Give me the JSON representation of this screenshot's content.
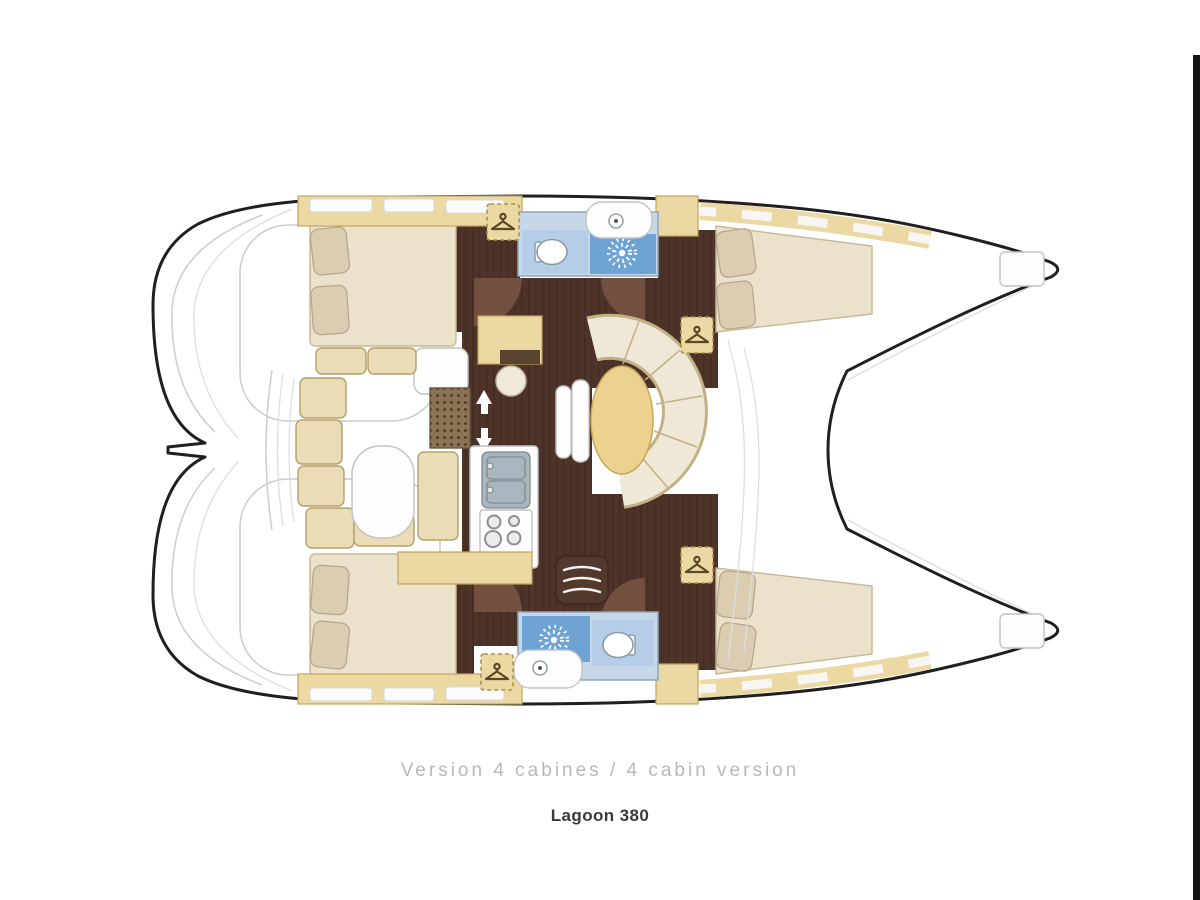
{
  "captions": {
    "version": "Version 4 cabines / 4 cabin version",
    "model": "Lagoon 380"
  },
  "legend": {
    "diagram_type": "catamaran interior floor plan, bows to the right",
    "rooms_depicted": [
      "aft cabin top hull",
      "forward cabin top hull",
      "aft cabin bottom hull",
      "forward cabin bottom hull",
      "bathroom top hull",
      "bathroom bottom hull",
      "saloon with dinette and oval table",
      "galley with double sink and stove",
      "navigation station with stool",
      "cockpit with bench seating and table",
      "stern platforms",
      "foredeck between bows"
    ]
  },
  "icons": {
    "wardrobe": "hanger-icon",
    "shower": "sunburst-icon",
    "toilet": "toilet-icon",
    "sink": "faucet-icon",
    "companionway": "up-down-arrow-icon"
  },
  "colors": {
    "outline": "#1f1f1f",
    "deck_line": "#cccccc",
    "beige": "#ecd8a2",
    "beige_border": "#c2a45f",
    "cushion": "#e9dcb6",
    "cushion_border": "#b3a06a",
    "mattress": "#ece2cb",
    "mattress_border": "#c6b896",
    "pillow": "#dbcdb1",
    "pillow_border": "#b3a58a",
    "floor_dark": "#4e3329",
    "door_arc": "#734f3f",
    "blue_light": "#b5cde6",
    "blue_mid": "#6fa3d4",
    "bath_bg": "#c6d8e8",
    "bath_border": "#8fa6bc",
    "table_tan": "#ecd28e",
    "table_border": "#c5a75c",
    "sofa_cream": "#efe8d7",
    "sofa_border": "#c2b185",
    "step_dark": "#53382c",
    "caption_gray": "#b8b8b8",
    "caption_dark": "#3a3a3a",
    "edge_bar": "#151515"
  }
}
